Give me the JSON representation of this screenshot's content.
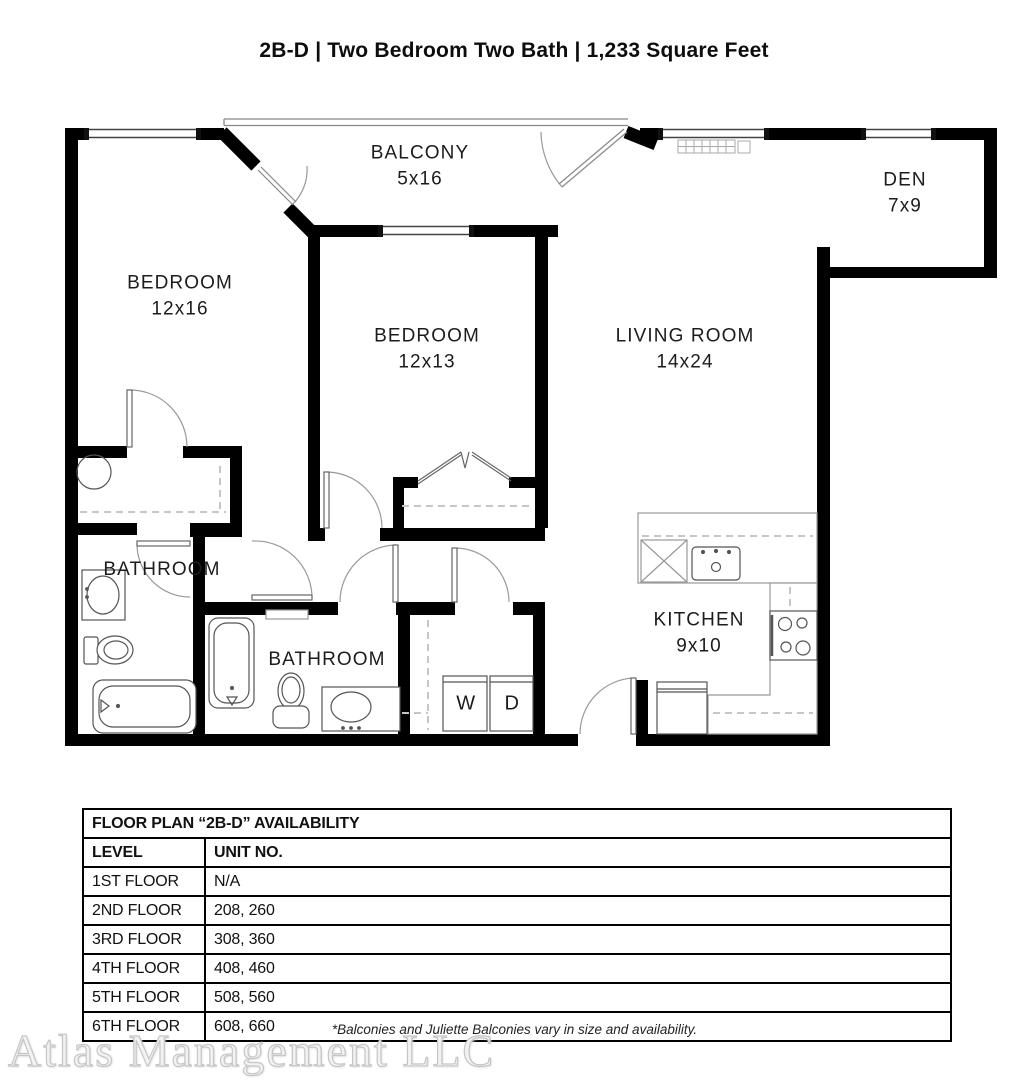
{
  "title": "2B-D | Two Bedroom Two Bath | 1,233 Square Feet",
  "rooms": {
    "balcony": {
      "name": "BALCONY",
      "dims": "5x16"
    },
    "den": {
      "name": "DEN",
      "dims": "7x9"
    },
    "bedroom1": {
      "name": "BEDROOM",
      "dims": "12x16"
    },
    "bedroom2": {
      "name": "BEDROOM",
      "dims": "12x13"
    },
    "living_room": {
      "name": "LIVING ROOM",
      "dims": "14x24"
    },
    "bathroom1": {
      "name": "BATHROOM"
    },
    "bathroom2": {
      "name": "BATHROOM"
    },
    "kitchen": {
      "name": "KITCHEN",
      "dims": "9x10"
    },
    "washer": "W",
    "dryer": "D"
  },
  "availability_table": {
    "title": "FLOOR PLAN “2B-D” AVAILABILITY",
    "columns": [
      "LEVEL",
      "UNIT NO."
    ],
    "rows": [
      [
        "1ST FLOOR",
        "N/A"
      ],
      [
        "2ND FLOOR",
        "208, 260"
      ],
      [
        "3RD FLOOR",
        "308, 360"
      ],
      [
        "4TH FLOOR",
        "408, 460"
      ],
      [
        "5TH FLOOR",
        "508, 560"
      ],
      [
        "6TH FLOOR",
        "608, 660"
      ]
    ]
  },
  "footnote": "*Balconies and Juliette Balconies vary in size and availability.",
  "watermark": "Atlas Management LLC",
  "colors": {
    "wall": "#000000",
    "fixture": "#555555",
    "door_arc": "#999999"
  }
}
